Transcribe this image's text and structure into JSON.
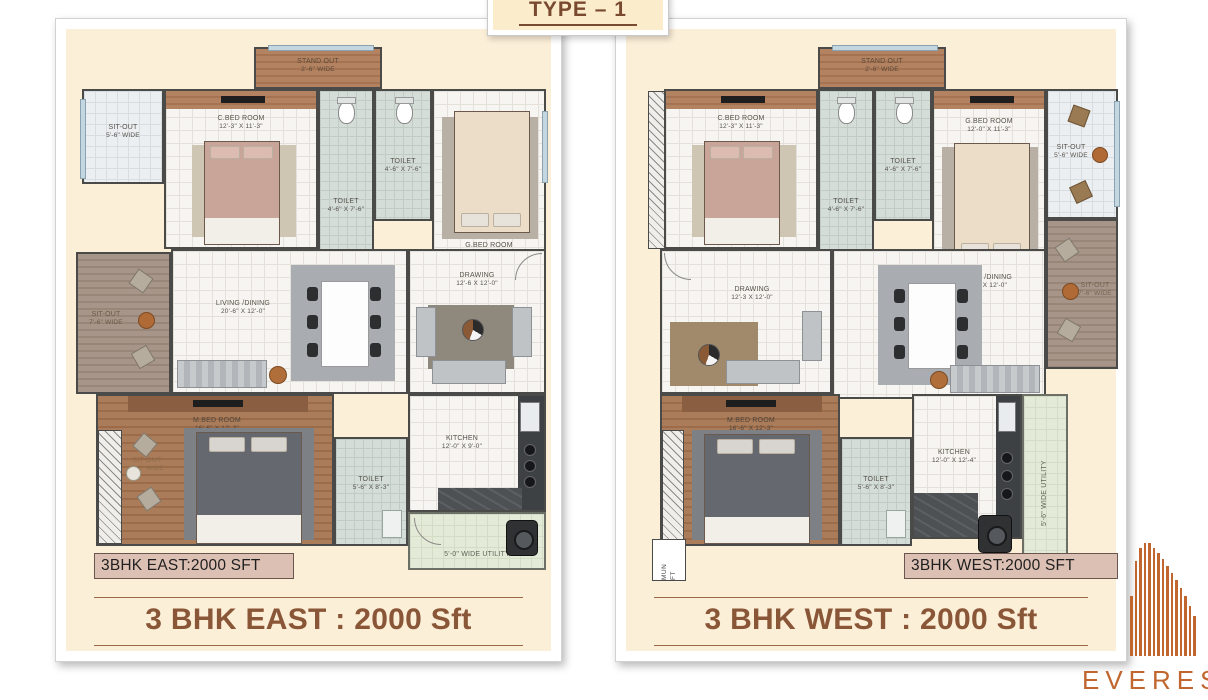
{
  "header": {
    "title": "TYPE – 1"
  },
  "plans": [
    {
      "id": "east",
      "badge": "3BHK EAST:2000 SFT",
      "caption": "3 BHK EAST : 2000 Sft",
      "rooms": {
        "stand_out": {
          "name": "STAND OUT",
          "dim": "2'-6\" WIDE"
        },
        "sit_out_top": {
          "name": "SIT-OUT",
          "dim": "5'-6\" WIDE"
        },
        "c_bed": {
          "name": "C.BED ROOM",
          "dim": "12'-3\" X 11'-3\""
        },
        "toilet_a": {
          "name": "TOILET",
          "dim": "4'-6\" X 7'-6\""
        },
        "toilet_b": {
          "name": "TOILET",
          "dim": "4'-6\" X 7'-6\""
        },
        "g_bed": {
          "name": "G.BED ROOM",
          "dim": "12'-0\" X 11'-3\""
        },
        "sit_out_side": {
          "name": "SIT-OUT",
          "dim": "7'-6\" WIDE"
        },
        "living": {
          "name": "LIVING /DINING",
          "dim": "20'-6\" X 12'-0\""
        },
        "drawing": {
          "name": "DRAWING",
          "dim": "12'-6 X 12'-0\""
        },
        "m_bed": {
          "name": "M.BED ROOM",
          "dim": "16'-6\" X 12'-3\""
        },
        "sit_out_bottom": {
          "name": "SIT-OUT",
          "dim": "5'-6\" WIDE"
        },
        "toilet_m": {
          "name": "TOILET",
          "dim": "5'-6\" X 8'-3\""
        },
        "kitchen": {
          "name": "KITCHEN",
          "dim": "12'-0\" X 9'-0\""
        },
        "utility": {
          "name": "5'-0\" WIDE UTILITY"
        }
      }
    },
    {
      "id": "west",
      "badge": "3BHK WEST:2000 SFT",
      "caption": "3 BHK WEST : 2000 Sft",
      "rooms": {
        "stand_out": {
          "name": "STAND OUT",
          "dim": "2'-6\" WIDE"
        },
        "c_bed": {
          "name": "C.BED ROOM",
          "dim": "12'-3\" X 11'-3\""
        },
        "toilet_a": {
          "name": "TOILET",
          "dim": "4'-6\" X 7'-6\""
        },
        "toilet_b": {
          "name": "TOILET",
          "dim": "4'-6\" X 7'-6\""
        },
        "g_bed": {
          "name": "G.BED ROOM",
          "dim": "12'-0\" X 11'-3\""
        },
        "sit_out_top": {
          "name": "SIT-OUT",
          "dim": "5'-6\" WIDE"
        },
        "sit_out_side": {
          "name": "SIT-OUT",
          "dim": "7'-6\" WIDE"
        },
        "drawing": {
          "name": "DRAWING",
          "dim": "12'-3 X 12'-0\""
        },
        "living": {
          "name": "LIVING /DINING",
          "dim": "20'-9\" X 12'-0\""
        },
        "m_bed": {
          "name": "M.BED ROOM",
          "dim": "16'-6\" X 12'-3\""
        },
        "toilet_m": {
          "name": "TOILET",
          "dim": "5'-6\" X 8'-3\""
        },
        "kitchen": {
          "name": "KITCHEN",
          "dim": "12'-0\" X 12'-4\""
        },
        "utility": {
          "name": "5'-6\" WIDE UTILITY"
        },
        "lift": {
          "line1": "MUN",
          "line2": "FT"
        }
      }
    }
  ],
  "logo": {
    "text": "EVEREST"
  },
  "colors": {
    "accent_brown": "#8a5638",
    "logo_orange": "#c0662e",
    "cream": "#fcefd8"
  }
}
